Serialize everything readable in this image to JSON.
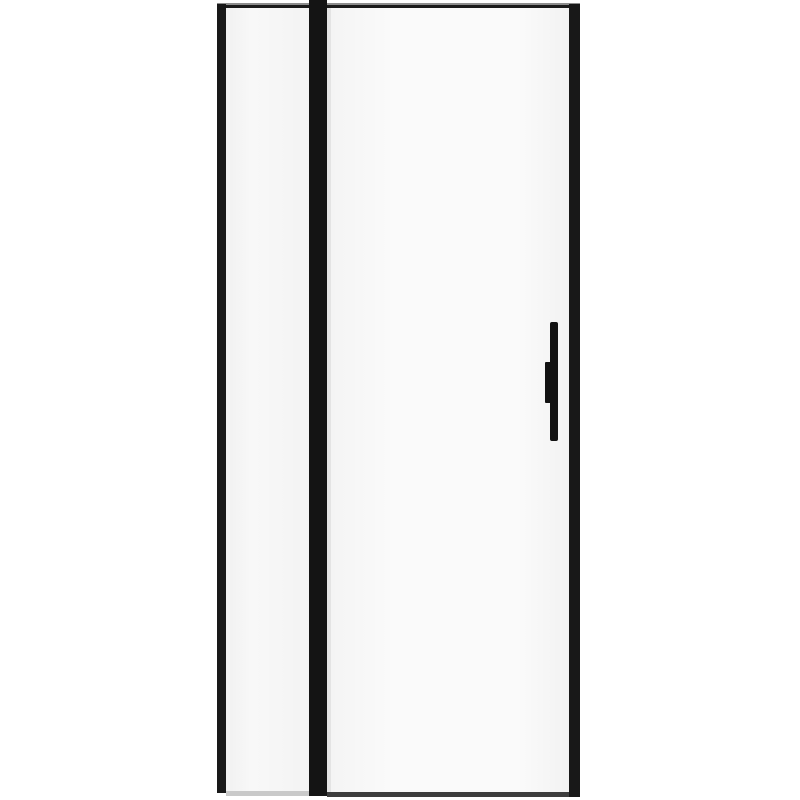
{
  "scene": {
    "subject": "framed-glass-door-product-photo",
    "background_color": "#ffffff",
    "colors": {
      "frame_black": "#181818",
      "center_stile_black": "#141414",
      "top_rail_dark": "#1b1b1b",
      "top_rail_highlight_gray": "#8d8d8d",
      "glass_white": "#f8f8f8",
      "door_glass_white": "#fafafa",
      "glass_edge_highlight": "#e4e4e4",
      "fixed_panel_sill_gray": "#c9c9c9",
      "door_bottom_rail_gray": "#3d3d3d",
      "handle_black": "#121212"
    },
    "components": {
      "top_rail": "top-rail",
      "left_stile": "left-frame-stile",
      "center_stile": "center-stile",
      "right_stile": "right-frame-stile",
      "fixed_panel": "fixed-panel-glass",
      "door_panel": "door-panel-glass",
      "fixed_panel_sill": "fixed-panel-bottom-sill",
      "door_bottom_rail": "door-bottom-rail",
      "handle_grip": "handle-grip-bar",
      "handle_bracket": "handle-mount-bracket"
    }
  }
}
